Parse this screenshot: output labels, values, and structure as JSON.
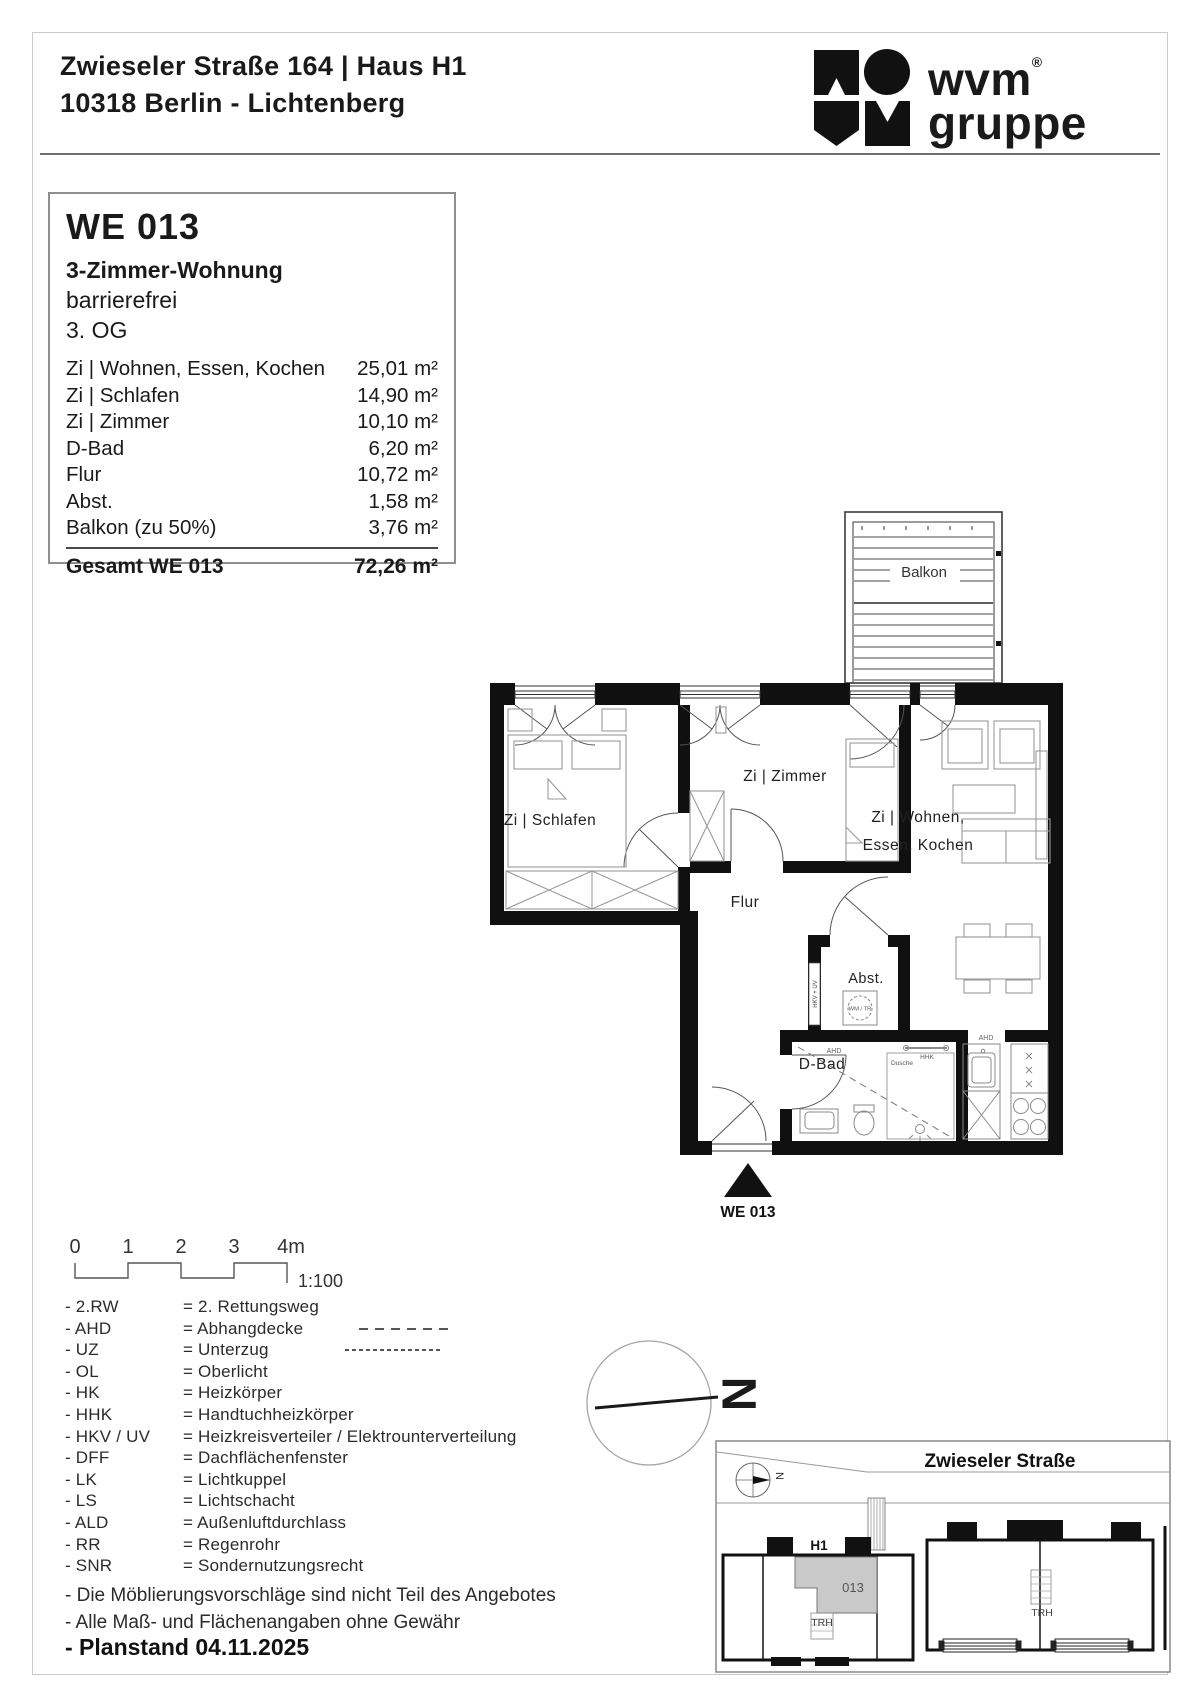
{
  "header": {
    "address_line1": "Zwieseler Straße 164  | Haus H1",
    "address_line2": "10318 Berlin - Lichtenberg",
    "logo": {
      "word": "wvm",
      "reg": "®",
      "sub": "gruppe"
    }
  },
  "info_box": {
    "unit_id": "WE 013",
    "unit_type": "3-Zimmer-Wohnung",
    "accessibility": "barrierefrei",
    "floor": "3. OG",
    "rooms": [
      {
        "label": "Zi | Wohnen, Essen, Kochen",
        "area": "25,01 m²"
      },
      {
        "label": "Zi | Schlafen",
        "area": "14,90 m²"
      },
      {
        "label": "Zi | Zimmer",
        "area": "10,10 m²"
      },
      {
        "label": "D-Bad",
        "area": "6,20 m²"
      },
      {
        "label": "Flur",
        "area": "10,72 m²"
      },
      {
        "label": "Abst.",
        "area": "1,58 m²"
      },
      {
        "label": "Balkon (zu 50%)",
        "area": "3,76 m²"
      }
    ],
    "total": {
      "label": "Gesamt WE 013",
      "area": "72,26 m²"
    }
  },
  "floor_plan": {
    "rooms": {
      "balkon": "Balkon",
      "schlafen": "Zi | Schlafen",
      "zimmer": "Zi | Zimmer",
      "wohnen_line1": "Zi | Wohnen,",
      "wohnen_line2": "Essen, Kochen",
      "flur": "Flur",
      "abst": "Abst.",
      "dbad": "D-Bad"
    },
    "annotations": {
      "wm_tr": "WM / TR",
      "hkv_uv": "HKV + UV",
      "ahd": "AHD",
      "hhk": "HHK",
      "dusche": "Dusche",
      "entrance_label": "WE 013"
    }
  },
  "scale_bar": {
    "ticks": [
      "0",
      "1",
      "2",
      "3",
      "4m"
    ],
    "ratio": "1:100"
  },
  "north_arrow": {
    "label": "N"
  },
  "legend": {
    "items": [
      {
        "abbr": "- 2.RW",
        "meaning": "= 2. Rettungsweg"
      },
      {
        "abbr": "- AHD",
        "meaning": "= Abhangdecke"
      },
      {
        "abbr": "- UZ",
        "meaning": "= Unterzug"
      },
      {
        "abbr": "- OL",
        "meaning": "= Oberlicht"
      },
      {
        "abbr": "- HK",
        "meaning": "= Heizkörper"
      },
      {
        "abbr": "- HHK",
        "meaning": "= Handtuchheizkörper"
      },
      {
        "abbr": "- HKV / UV",
        "meaning": "= Heizkreisverteiler / Elektrounterverteilung"
      },
      {
        "abbr": "- DFF",
        "meaning": "= Dachflächenfenster"
      },
      {
        "abbr": "- LK",
        "meaning": "= Lichtkuppel"
      },
      {
        "abbr": "- LS",
        "meaning": "= Lichtschacht"
      },
      {
        "abbr": "- ALD",
        "meaning": "= Außenluftdurchlass"
      },
      {
        "abbr": "- RR",
        "meaning": "= Regenrohr"
      },
      {
        "abbr": "- SNR",
        "meaning": "= Sondernutzungsrecht"
      }
    ],
    "notes": [
      "- Die Möblierungsvorschläge sind nicht Teil des Angebotes",
      "- Alle Maß- und Flächenangaben ohne Gewähr"
    ],
    "plan_date": "- Planstand 04.11.2025"
  },
  "site_plan": {
    "street": "Zwieseler Straße",
    "building": "H1",
    "unit": "013",
    "trh_left": "TRH",
    "trh_right": "TRH",
    "north": "N"
  },
  "colors": {
    "wall": "#101010",
    "furniture": "#9a9a9a",
    "unit_highlight": "#c9c9c9",
    "rule": "#6f6f6f"
  }
}
